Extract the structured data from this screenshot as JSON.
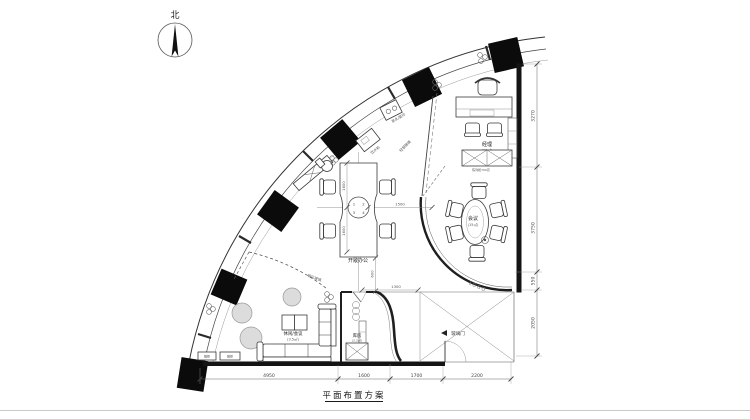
{
  "compass": {
    "label": "北"
  },
  "title": {
    "text": "平面布置方案"
  },
  "rooms": {
    "manager": {
      "name": "经理",
      "area": "(10㎡)"
    },
    "meeting": {
      "name": "会议",
      "area": "(15㎡)"
    },
    "open_office": {
      "name": "开敞办公"
    },
    "lounge": {
      "name": "休闲/会议",
      "area": "(3.5㎡)"
    },
    "storage": {
      "name": "库房",
      "area": "(2.2㎡)"
    }
  },
  "labels": {
    "logo_wall": "LOGO",
    "glass_door": "玻璃门",
    "tempered_glass": "钢化玻璃",
    "light_steel_glass": "轻钢玻璃",
    "display_cabinet": "陈列柜700高",
    "low_cabinet_a": "矮柜",
    "low_cabinet_b": "矮柜",
    "pantry_copy": "茶水/复印",
    "water_dispenser": "饮水机"
  },
  "grid_bubble": {
    "n1": "1",
    "n2": "2",
    "n3": "3",
    "n4": "4"
  },
  "dims": {
    "right": [
      "3270",
      "3750",
      "550",
      "2050"
    ],
    "bottom": [
      "4950",
      "1600",
      "1700",
      "2200"
    ],
    "desk_upper": "1600",
    "desk_lower": "1600",
    "desk_right": "1500",
    "below_desk": "600",
    "corridor": "1300"
  },
  "colors": {
    "wall": "#141414",
    "column": "#0b0b0b",
    "plant_fill": "#dcdcdc"
  }
}
